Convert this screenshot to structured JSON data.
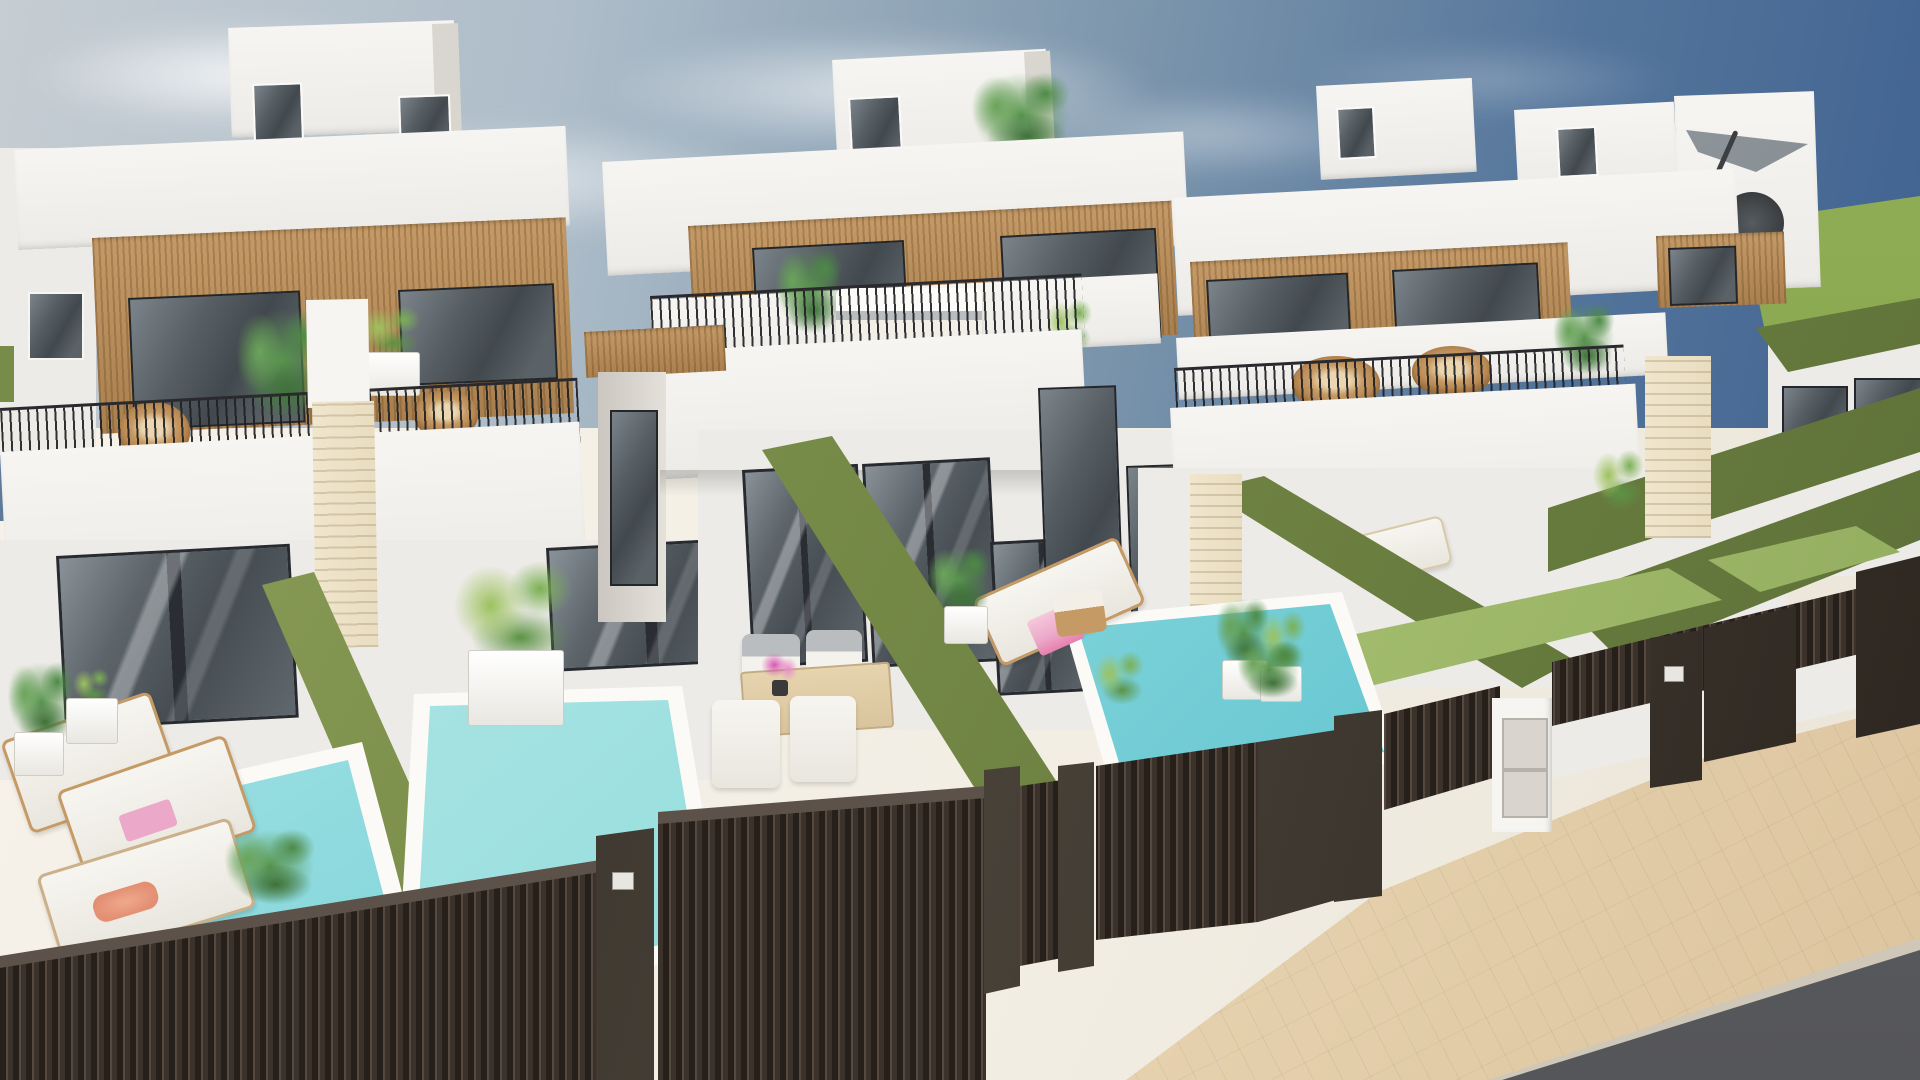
{
  "scene": {
    "type": "architectural-3d-render",
    "subject": "row of modern two-storey white townhouse villas with private plunge pools",
    "view": "elevated front corner view from the street",
    "sky": "partly cloudy, brighter at left, deep blue at upper right",
    "horizon_right": "flat green field",
    "street": "paved sidewalk and asphalt road along the bottom right"
  },
  "colors": {
    "sky_light": "#c6cdd3",
    "sky_mid": "#7e97ad",
    "sky_deep": "#3f6190",
    "field_green": "#85a44c",
    "wall_white": "#f6f5f2",
    "wall_tint": "#edebe7",
    "wall_shadow": "#d9d6d0",
    "wood": "#c59a67",
    "wood_dark": "#a87f4e",
    "glass_dark": "#42494e",
    "glass_light": "#7b848a",
    "frame_dark": "#23272b",
    "travertine": "#e9ddc1",
    "hedge": "#788c49",
    "hedge_dark": "#5e7138",
    "hedge_light": "#95a75f",
    "lawn": "#a9c273",
    "pool_light": "#c8eeea",
    "pool_mid": "#8edade",
    "pool_deep": "#5fc3cf",
    "coping": "#fbfaf6",
    "floor": "#f2eee4",
    "fence": "#3a322b",
    "fence_dark": "#261f1a",
    "fence_light": "#564a40",
    "walk": "#e8d4b2",
    "road": "#55565a",
    "wicker": "#c69a64",
    "wood_furniture": "#d9c49d",
    "cushion_white": "#f7f5f0",
    "cushion_gray": "#b9bdbf",
    "pink": "#eba8c8",
    "flower_pink": "#d857b2",
    "coral": "#e38f73",
    "parasol_gray": "#9aa1a6"
  },
  "houses": [
    {
      "id": "left-house",
      "features": [
        "rooftop access box with two glazed doors",
        "wood-slat upper facade with two dark windows",
        "balcony with thin metal railing and two wicker chairs",
        "balcony palms and white planter",
        "white-capped travertine chimney pillar",
        "ground floor glass sliding doors",
        "front yard with pool"
      ]
    },
    {
      "id": "middle-house",
      "features": [
        "rooftop access box with glazed door",
        "rooftop plant",
        "wood-slat upper facade with two dark windows",
        "balcony with white outdoor sofa and plants",
        "recessed entry with wood soffit",
        "ground floor glass doors",
        "dining terrace and pool"
      ]
    },
    {
      "id": "right-house",
      "features": [
        "two rooftop boxes",
        "roof terrace with gray cantilever parasol and dark wicker chair",
        "wood-slat facade with dark windows",
        "balcony with wicker chairs and plants",
        "artificial lawn strips",
        "fenced yard"
      ]
    }
  ],
  "pools": [
    {
      "id": "pool-left",
      "water": "light turquoise"
    },
    {
      "id": "pool-center",
      "water": "light turquoise"
    },
    {
      "id": "pool-right",
      "water": "turquoise, deeper at far end"
    }
  ],
  "street_elements": [
    "dark slatted privacy fence",
    "solid dark gate panels",
    "gate posts",
    "white utility pillar with two meter doors",
    "small letterbox plaques",
    "beige paved sidewalk",
    "asphalt road"
  ],
  "vegetation": [
    "potted palms on terraces",
    "balcony planters",
    "green hedge walls dividing the yards",
    "lawn strips",
    "plants peeking over the fence"
  ],
  "furniture": [
    "wicker lounge chairs",
    "white outdoor sofa",
    "wooden sun loungers with white cushions",
    "pink towels",
    "dining table with four chairs",
    "pink flower centerpiece",
    "wooden side stool",
    "tray with coral item",
    "gray parasol"
  ]
}
